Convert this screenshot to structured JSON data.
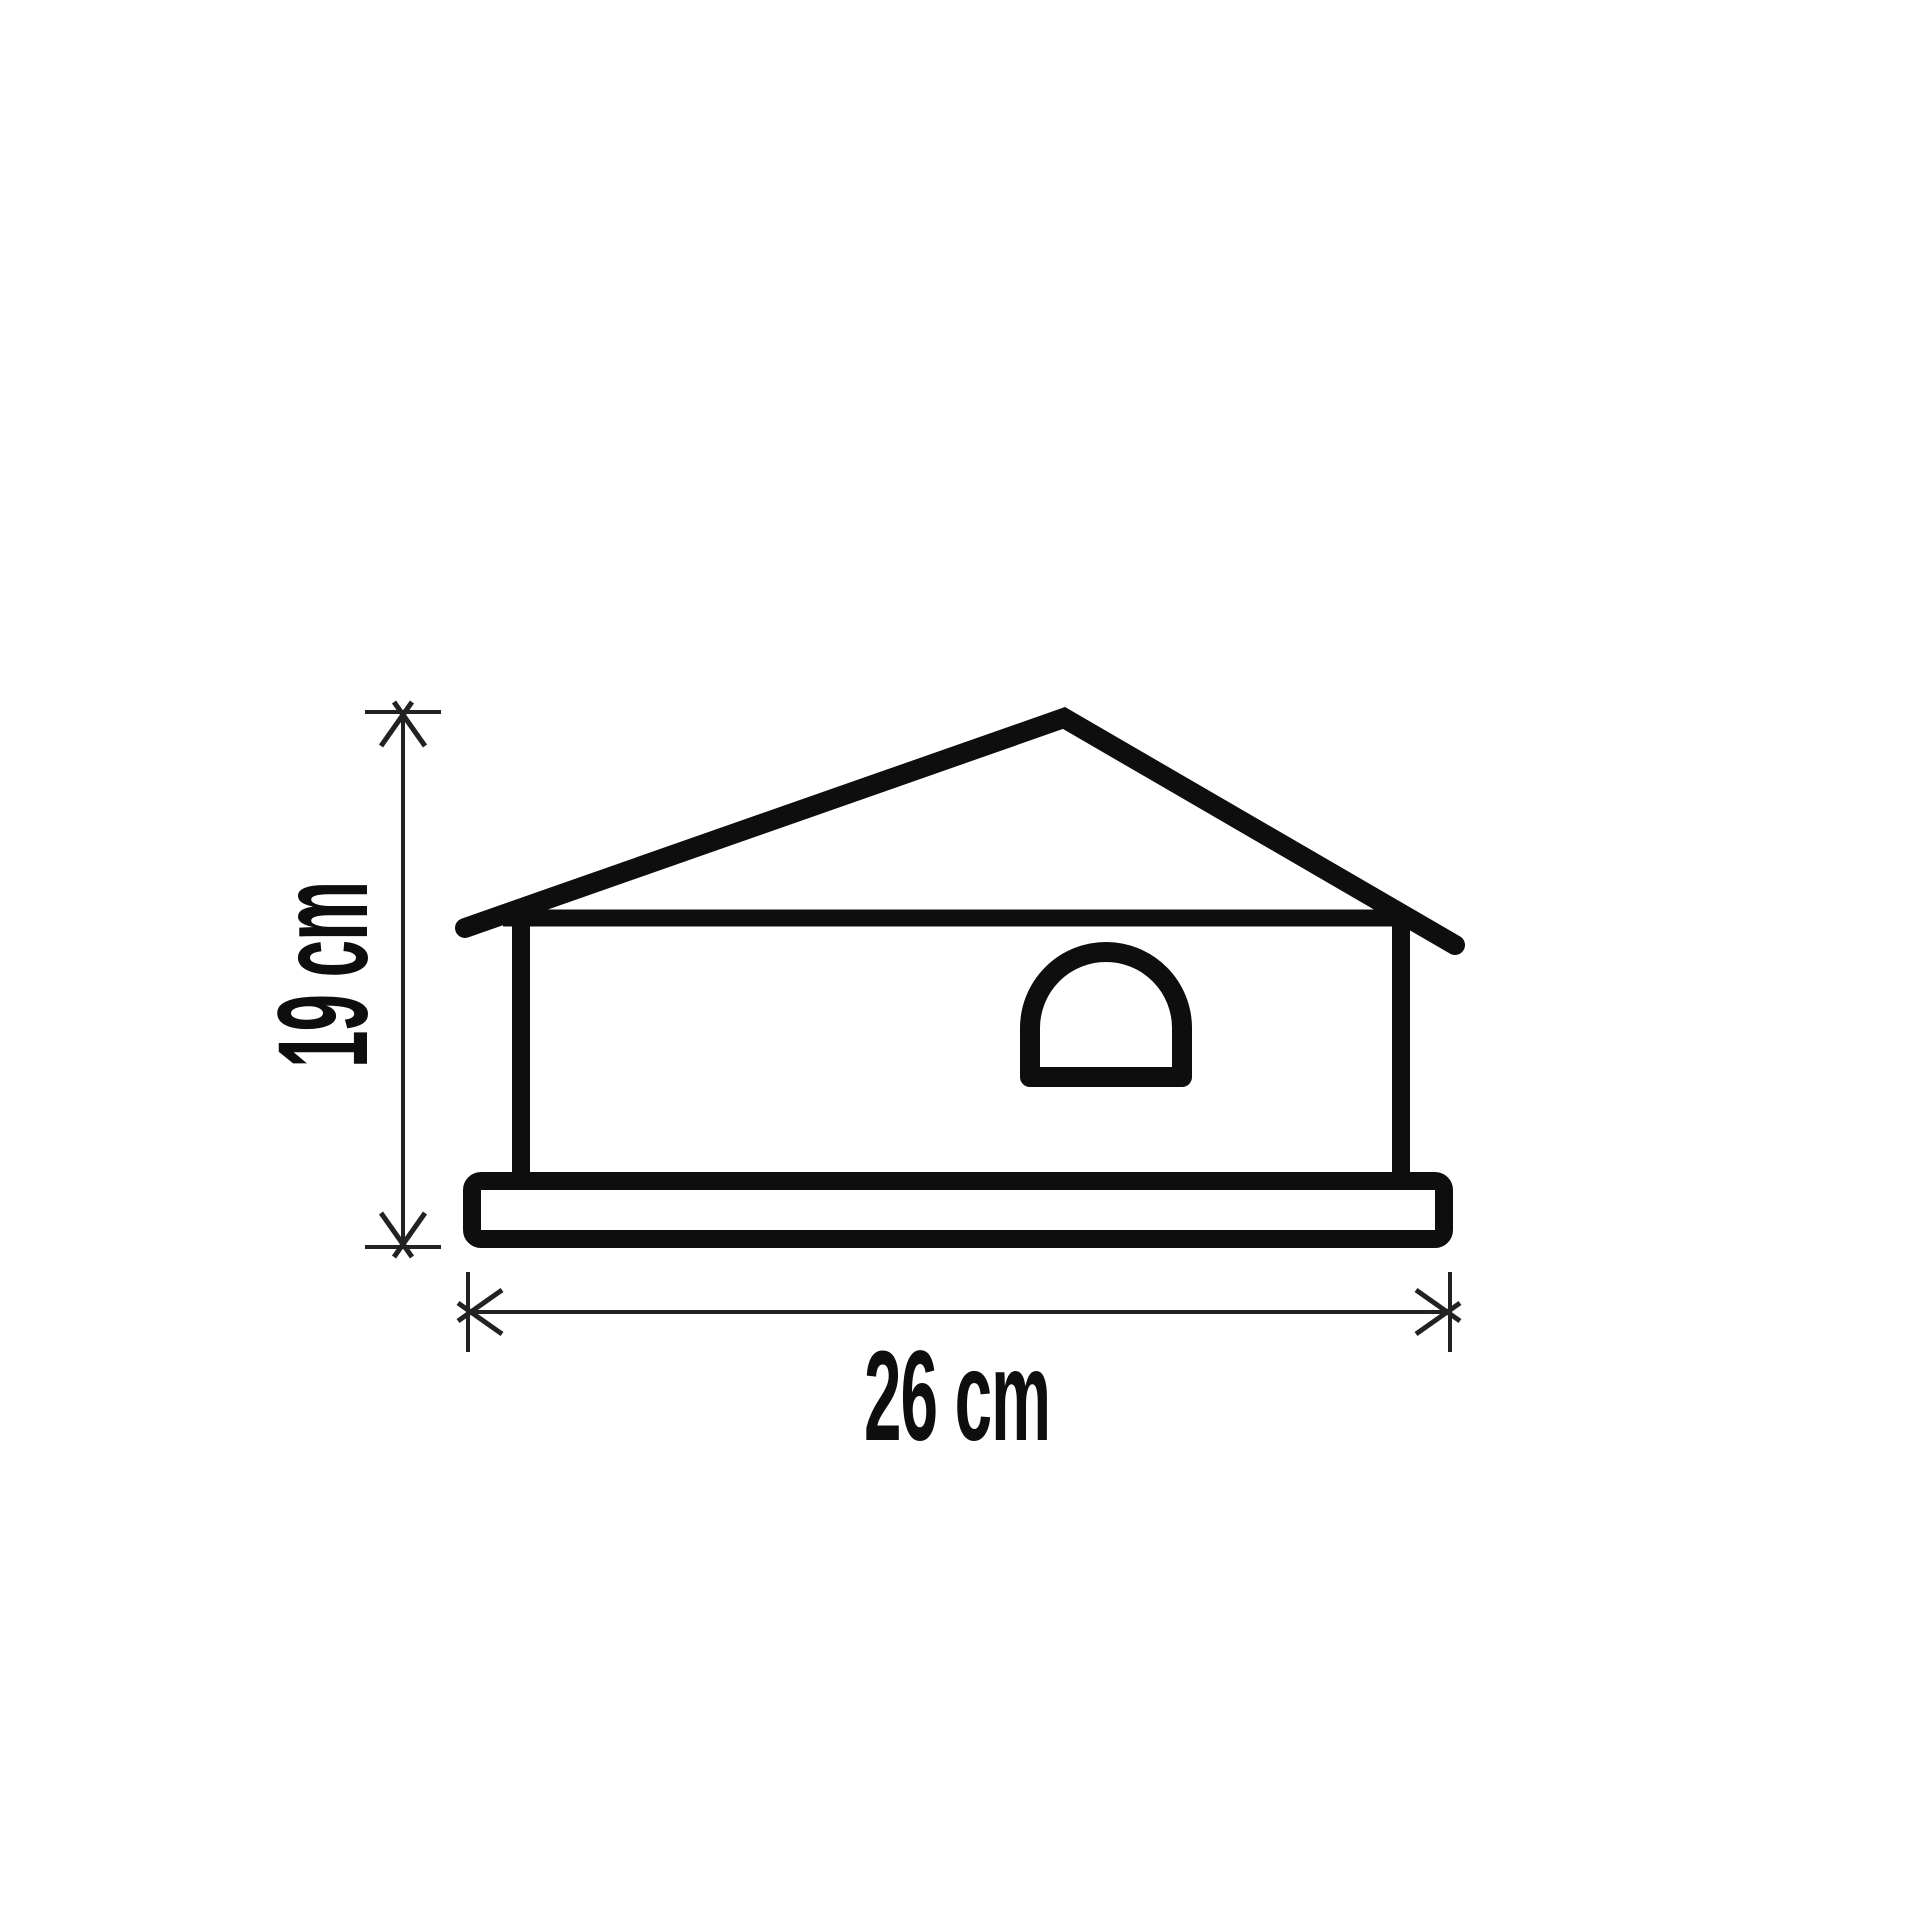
{
  "diagram": {
    "subject": "house-shaped product outline with overall dimensions",
    "dimensions": {
      "height": {
        "value": 19,
        "unit": "cm",
        "label": "19 cm"
      },
      "width": {
        "value": 26,
        "unit": "cm",
        "label": "26 cm"
      }
    }
  },
  "colors": {
    "line_color": "#0e0e0e",
    "thin_line_color": "#222222",
    "background": "#ffffff"
  }
}
